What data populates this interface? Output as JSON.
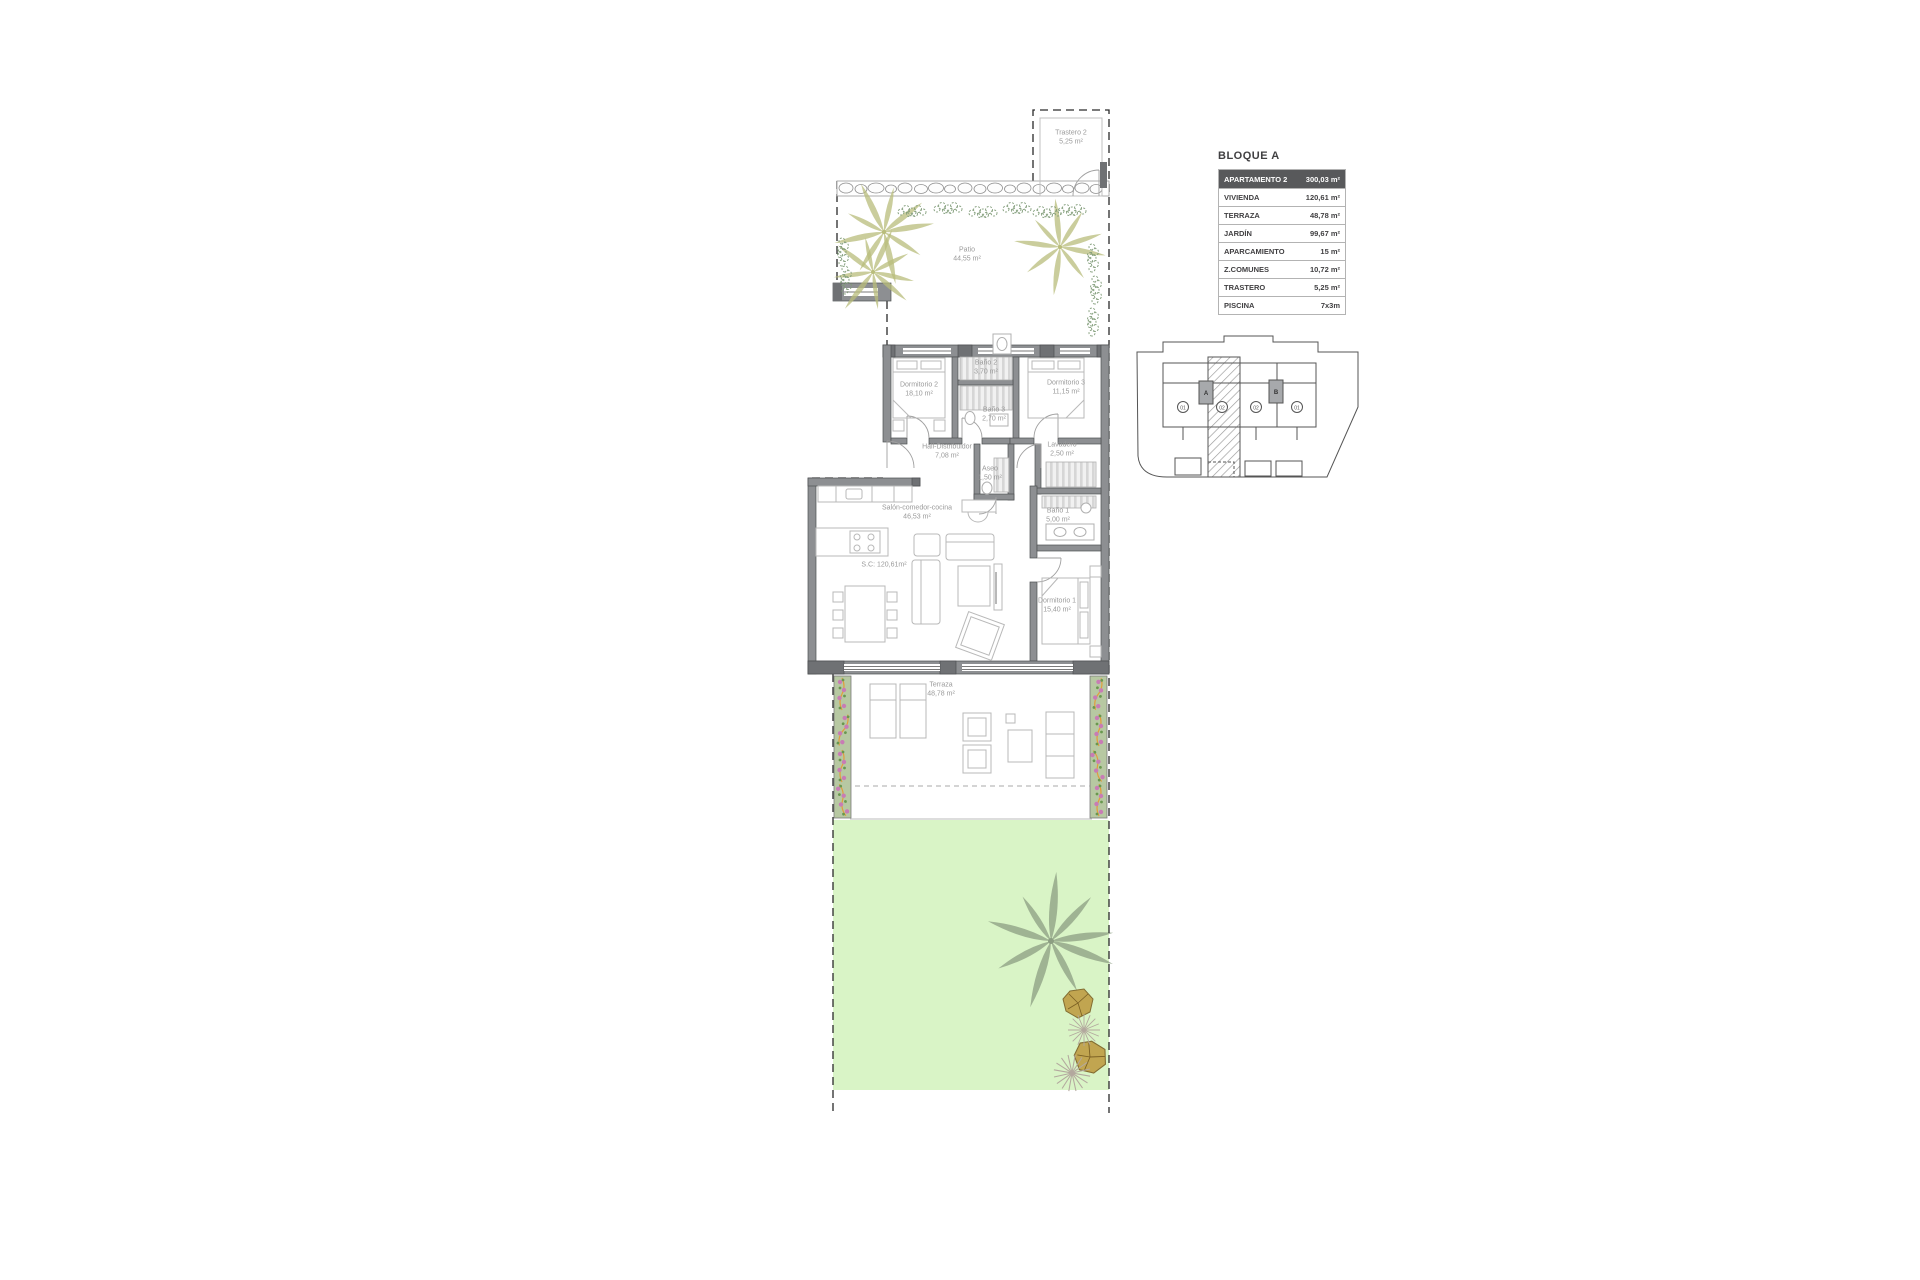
{
  "info_table": {
    "title": "BLOQUE A",
    "header": {
      "label": "APARTAMENTO 2",
      "value": "300,03 m²"
    },
    "rows": [
      {
        "label": "VIVIENDA",
        "value": "120,61 m²"
      },
      {
        "label": "TERRAZA",
        "value": "48,78 m²"
      },
      {
        "label": "JARDÍN",
        "value": "99,67 m²"
      },
      {
        "label": "APARCAMIENTO",
        "value": "15 m²"
      },
      {
        "label": "Z.COMUNES",
        "value": "10,72 m²"
      },
      {
        "label": "TRASTERO",
        "value": "5,25 m²"
      },
      {
        "label": "PISCINA",
        "value": "7x3m"
      }
    ]
  },
  "floor_plan": {
    "rooms": [
      {
        "name": "Trastero 2",
        "area": "5,25 m²"
      },
      {
        "name": "Patio",
        "area": "44,55 m²"
      },
      {
        "name": "Dormitorio 2",
        "area": "18,10 m²"
      },
      {
        "name": "Baño 2",
        "area": "3,70 m²"
      },
      {
        "name": "Dormitorio 3",
        "area": "11,15 m²"
      },
      {
        "name": "Baño 3",
        "area": "2,70 m²"
      },
      {
        "name": "Hall-Distribuidor",
        "area": "7,08 m²"
      },
      {
        "name": "Aseo",
        "area": "1,50 m²"
      },
      {
        "name": "Lavadero",
        "area": "2,50 m²"
      },
      {
        "name": "Salón-comedor-cocina",
        "area": "46,53 m²"
      },
      {
        "name": "S.C: 120,61m²"
      },
      {
        "name": "Baño 1",
        "area": "5,00 m²"
      },
      {
        "name": "Dormitorio 1",
        "area": "15,40 m²"
      },
      {
        "name": "Terraza",
        "area": "48,78 m²"
      }
    ]
  },
  "site_plan": {
    "block_a_label": "A",
    "block_b_label": "B",
    "units": [
      "01",
      "02",
      "02",
      "01"
    ]
  },
  "colors": {
    "wall_gray": "#8d8f92",
    "pier_gray": "#6f7174",
    "table_header_bg": "#58595b",
    "garden_green": "#d9f4c6",
    "planter_green": "#b7c8a2",
    "palm_yellow": "#b9bd7b",
    "palm_gray": "#8c9e82",
    "bush_green": "#7f9b77",
    "flower_pink": "#c87cb5",
    "stem_orange": "#e29d3c",
    "label_gray": "#9a9a9a"
  }
}
